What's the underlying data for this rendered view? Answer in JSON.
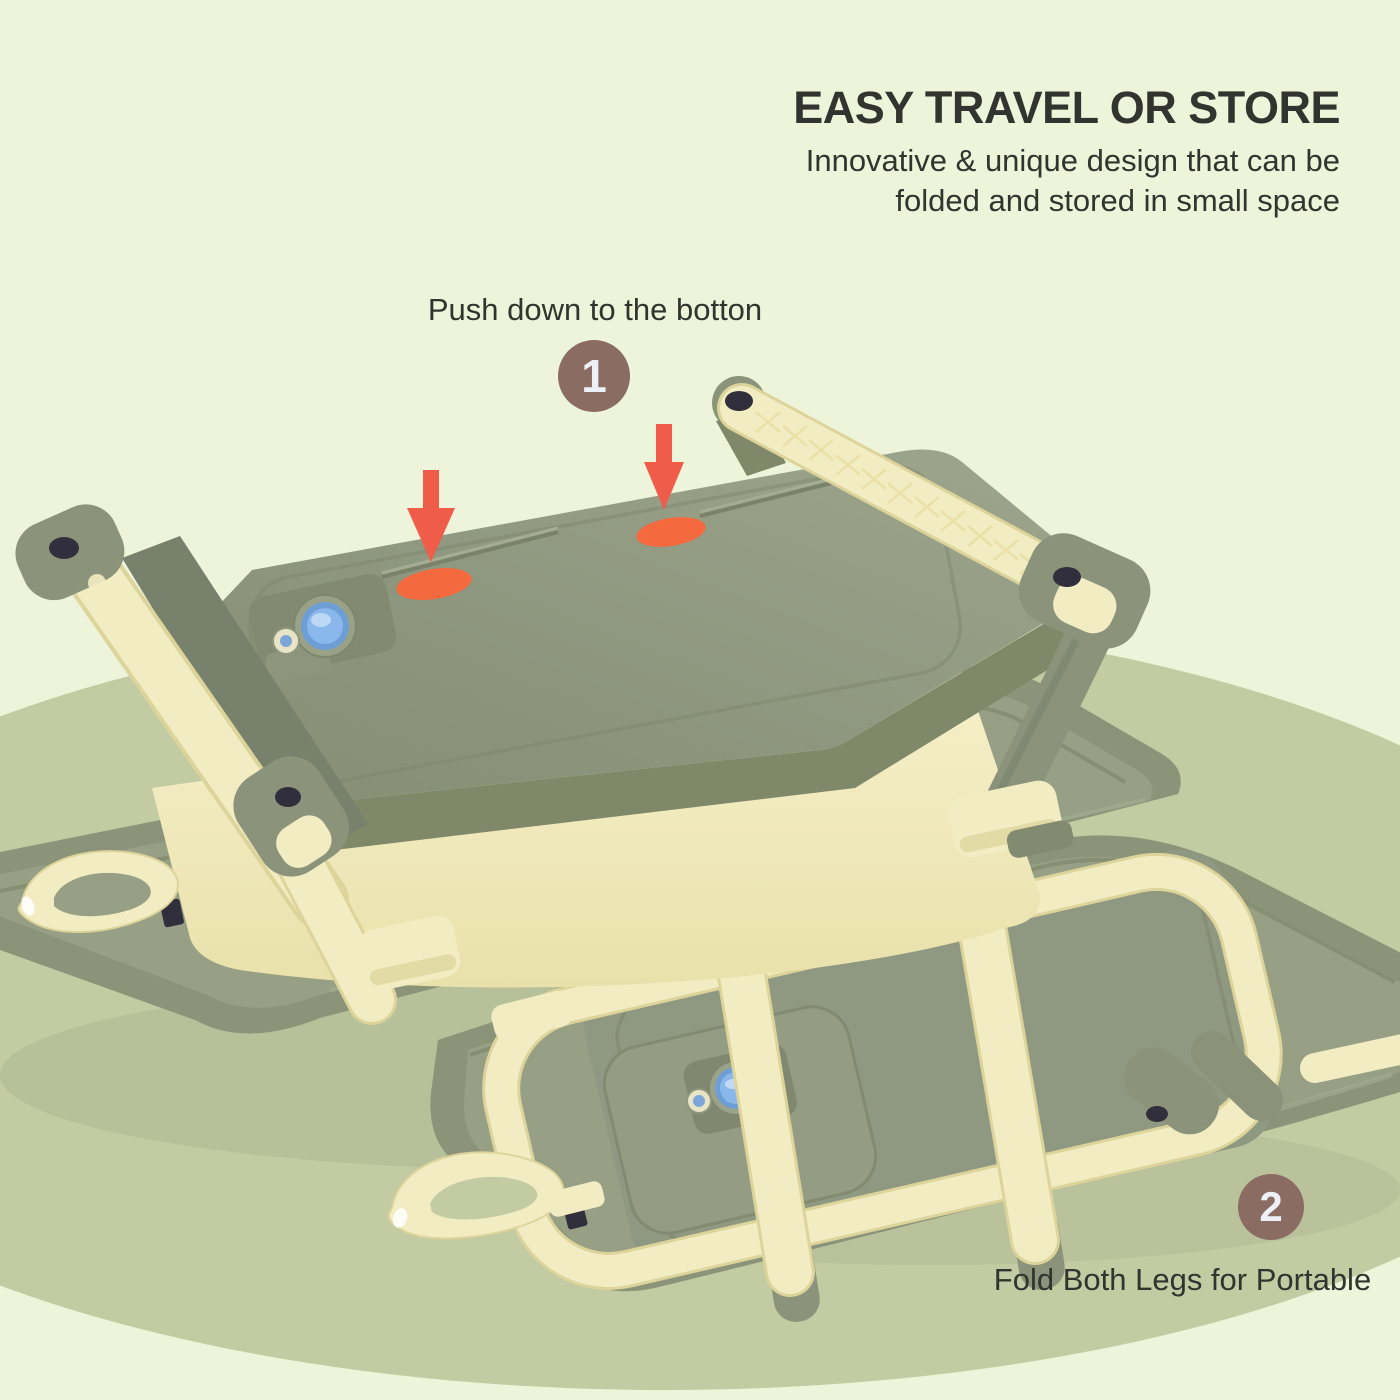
{
  "header": {
    "title": "EASY TRAVEL OR STORE",
    "subtitle_line1": "Innovative & unique design that can be",
    "subtitle_line2": "folded and stored in small space"
  },
  "steps": [
    {
      "number": "1",
      "label": "Push down to the botton"
    },
    {
      "number": "2",
      "label": "Fold Both Legs for Portable"
    }
  ],
  "colors": {
    "bg": "#eef4d9",
    "ellipse": "#c2cba2",
    "cream": "#f2ecc2",
    "cream-shadow": "#e3dba6",
    "cream-edge": "#dcd49a",
    "green-slab": "#8f9880",
    "green-dark": "#7b8468",
    "tray-green": "#8b9479",
    "tray-floor": "#97a085",
    "leg-green": "#8b947a",
    "navy": "#312f3c",
    "plug-blue": "#8ab7ec",
    "plug-ring": "#6d9ed6",
    "accent-orange": "#f5693f",
    "arrow-red": "#ef5c4a",
    "badge-brown": "#8a6c63",
    "text-dark": "#333330"
  }
}
